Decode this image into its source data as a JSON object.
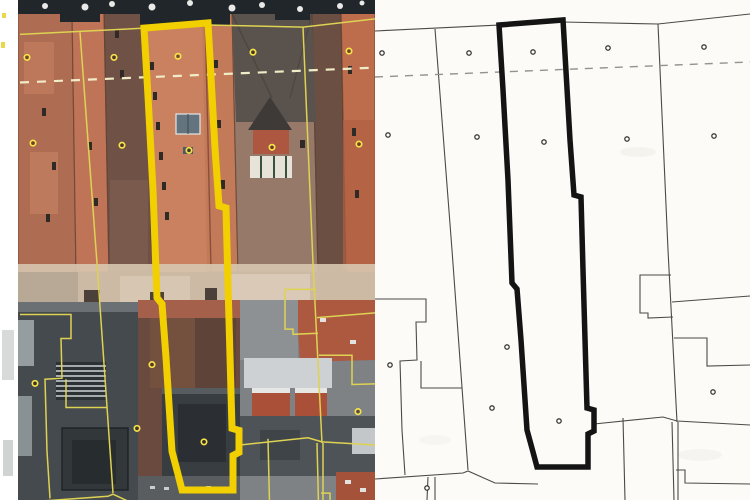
{
  "figure": {
    "kind": "cadastre-orthophoto-comparison",
    "panel_count": 2
  },
  "cadastre": {
    "space": {
      "width": 375,
      "height": 500
    },
    "parcel_outline": [
      [
        124,
        25
      ],
      [
        188,
        20
      ],
      [
        195,
        140
      ],
      [
        199,
        195
      ],
      [
        206,
        197
      ],
      [
        208,
        270
      ],
      [
        212,
        408
      ],
      [
        219,
        410
      ],
      [
        219,
        431
      ],
      [
        213,
        434
      ],
      [
        213,
        467
      ],
      [
        162,
        467
      ],
      [
        158,
        452
      ],
      [
        152,
        430
      ],
      [
        146,
        340
      ],
      [
        142,
        289
      ],
      [
        137,
        283
      ],
      [
        133,
        180
      ],
      [
        128,
        90
      ]
    ],
    "thin_lines": [
      [
        [
          0,
          31
        ],
        [
          188,
          22
        ],
        [
          283,
          24
        ],
        [
          375,
          14
        ]
      ],
      [
        [
          60,
          29
        ],
        [
          77,
          250
        ],
        [
          93,
          470
        ]
      ],
      [
        [
          283,
          24
        ],
        [
          293,
          250
        ],
        [
          302,
          422
        ]
      ],
      [
        [
          0,
          299
        ],
        [
          51,
          299
        ],
        [
          51,
          322
        ],
        [
          41,
          322
        ],
        [
          42,
          360
        ],
        [
          25,
          361
        ],
        [
          27,
          430
        ],
        [
          30,
          475
        ]
      ],
      [
        [
          46,
          361
        ],
        [
          46,
          388
        ],
        [
          87,
          388
        ]
      ],
      [
        [
          0,
          479
        ],
        [
          88,
          473
        ],
        [
          93,
          471
        ],
        [
          120,
          483
        ],
        [
          163,
          484
        ]
      ],
      [
        [
          53,
          477
        ],
        [
          52,
          500
        ]
      ],
      [
        [
          60,
          477
        ],
        [
          60,
          500
        ]
      ],
      [
        [
          296,
          275
        ],
        [
          265,
          275
        ],
        [
          265,
          313
        ],
        [
          273,
          313
        ],
        [
          273,
          318
        ],
        [
          298,
          317
        ]
      ],
      [
        [
          297,
          302
        ],
        [
          375,
          296
        ]
      ],
      [
        [
          299,
          338
        ],
        [
          332,
          338
        ],
        [
          332,
          366
        ],
        [
          375,
          365
        ]
      ],
      [
        [
          219,
          424
        ],
        [
          288,
          417
        ],
        [
          302,
          421
        ],
        [
          375,
          425
        ]
      ],
      [
        [
          297,
          422
        ],
        [
          299,
          500
        ]
      ],
      [
        [
          303,
          422
        ],
        [
          303,
          500
        ]
      ],
      [
        [
          301,
          470
        ],
        [
          310,
          470
        ],
        [
          310,
          483
        ],
        [
          375,
          484
        ]
      ],
      [
        [
          248,
          418
        ],
        [
          250,
          500
        ]
      ]
    ],
    "dashed_lines": [
      [
        [
          0,
          77
        ],
        [
          375,
          62
        ]
      ]
    ],
    "markers": [
      [
        7,
        53
      ],
      [
        94,
        53
      ],
      [
        158,
        52
      ],
      [
        233,
        48
      ],
      [
        329,
        47
      ],
      [
        13,
        135
      ],
      [
        102,
        137
      ],
      [
        169,
        142
      ],
      [
        252,
        139
      ],
      [
        339,
        136
      ],
      [
        15,
        365
      ],
      [
        132,
        347
      ],
      [
        117,
        408
      ],
      [
        184,
        421
      ],
      [
        338,
        392
      ],
      [
        52,
        488
      ]
    ]
  },
  "panels": {
    "left": {
      "label": "orthophoto with cadastre overlay",
      "transform": {
        "dx": 20,
        "dy": 2,
        "sx": 1.0,
        "sy": 1.045
      },
      "style": {
        "thin_color": "#ded253",
        "thin_width": 1.5,
        "thick_color": "#f2cf00",
        "thick_width": 7,
        "dash_color": "#f1ecc8",
        "dash_width": 2.2,
        "dash_pattern": "9 8",
        "marker_stroke": "#f8e24a",
        "marker_stroke_width": 1.7,
        "marker_fill": "rgba(50,35,15,0.55)",
        "marker_r": 2.7
      }
    },
    "right": {
      "label": "cadastral map",
      "transform": {
        "dx": 0,
        "dy": 0,
        "sx": 1.0,
        "sy": 1.0
      },
      "style": {
        "thin_color": "#4a4a48",
        "thin_width": 1.1,
        "thick_color": "#141414",
        "thick_width": 5.5,
        "dash_color": "#92928e",
        "dash_width": 1.4,
        "dash_pattern": "8 7",
        "marker_stroke": "#3a3a38",
        "marker_stroke_width": 1.3,
        "marker_fill": "#ffffff",
        "marker_r": 2.2
      }
    }
  }
}
